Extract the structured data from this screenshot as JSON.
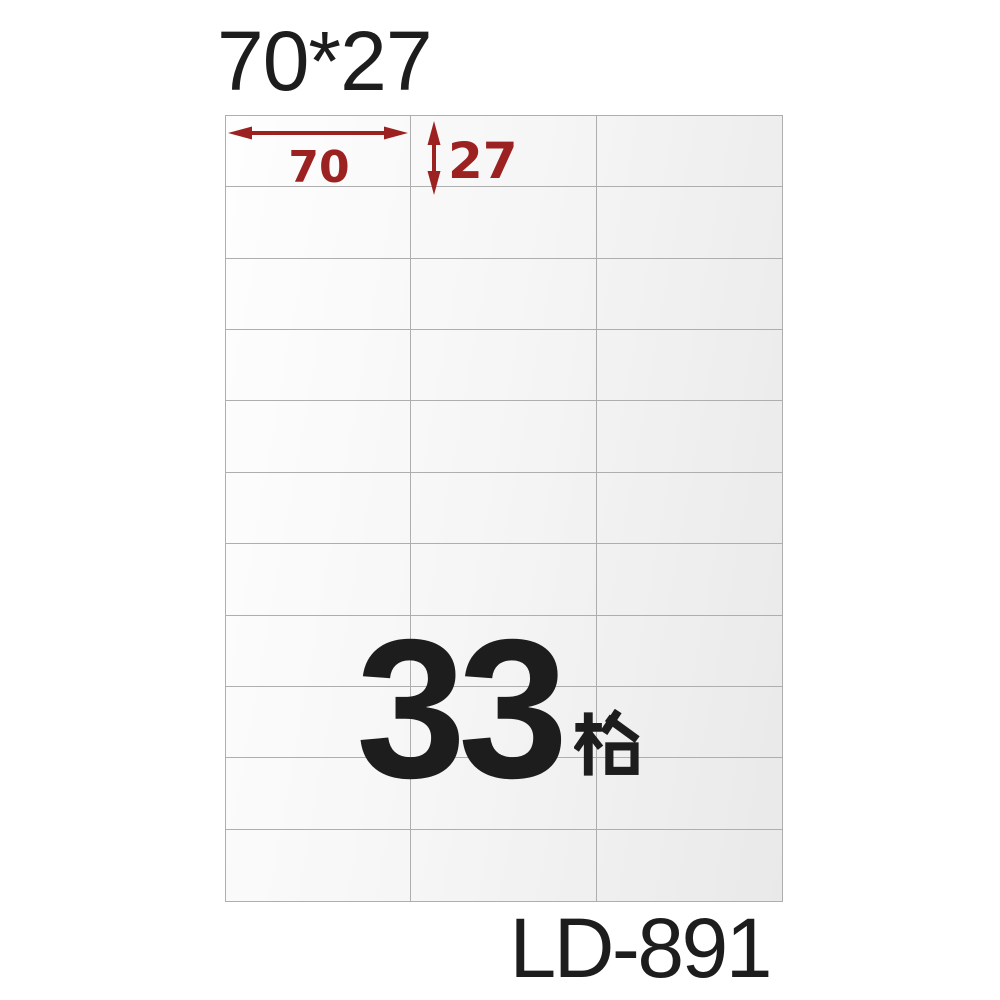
{
  "product": {
    "size_title": "70*27",
    "model": "LD-891",
    "cell_count": "33",
    "cell_count_unit": "格",
    "cell_count_full": "33格"
  },
  "dimension_labels": {
    "width_mm": "70",
    "height_mm": "27"
  },
  "grid": {
    "columns": 3,
    "rows": 11,
    "total_cells": 33
  },
  "icons": {
    "width_arrow": "horizontal-double-headed-arrow",
    "height_arrow": "vertical-double-headed-arrow",
    "ge_glyph": "chinese-character-ge"
  },
  "colors": {
    "dimension_red": "#9c2222",
    "text_black": "#1d1d1d",
    "grid_line": "#aeaeae",
    "sheet_start": "#fefefe",
    "sheet_mid": "#f6f6f6",
    "sheet_end": "#e9e9e9",
    "background": "#ffffff"
  }
}
